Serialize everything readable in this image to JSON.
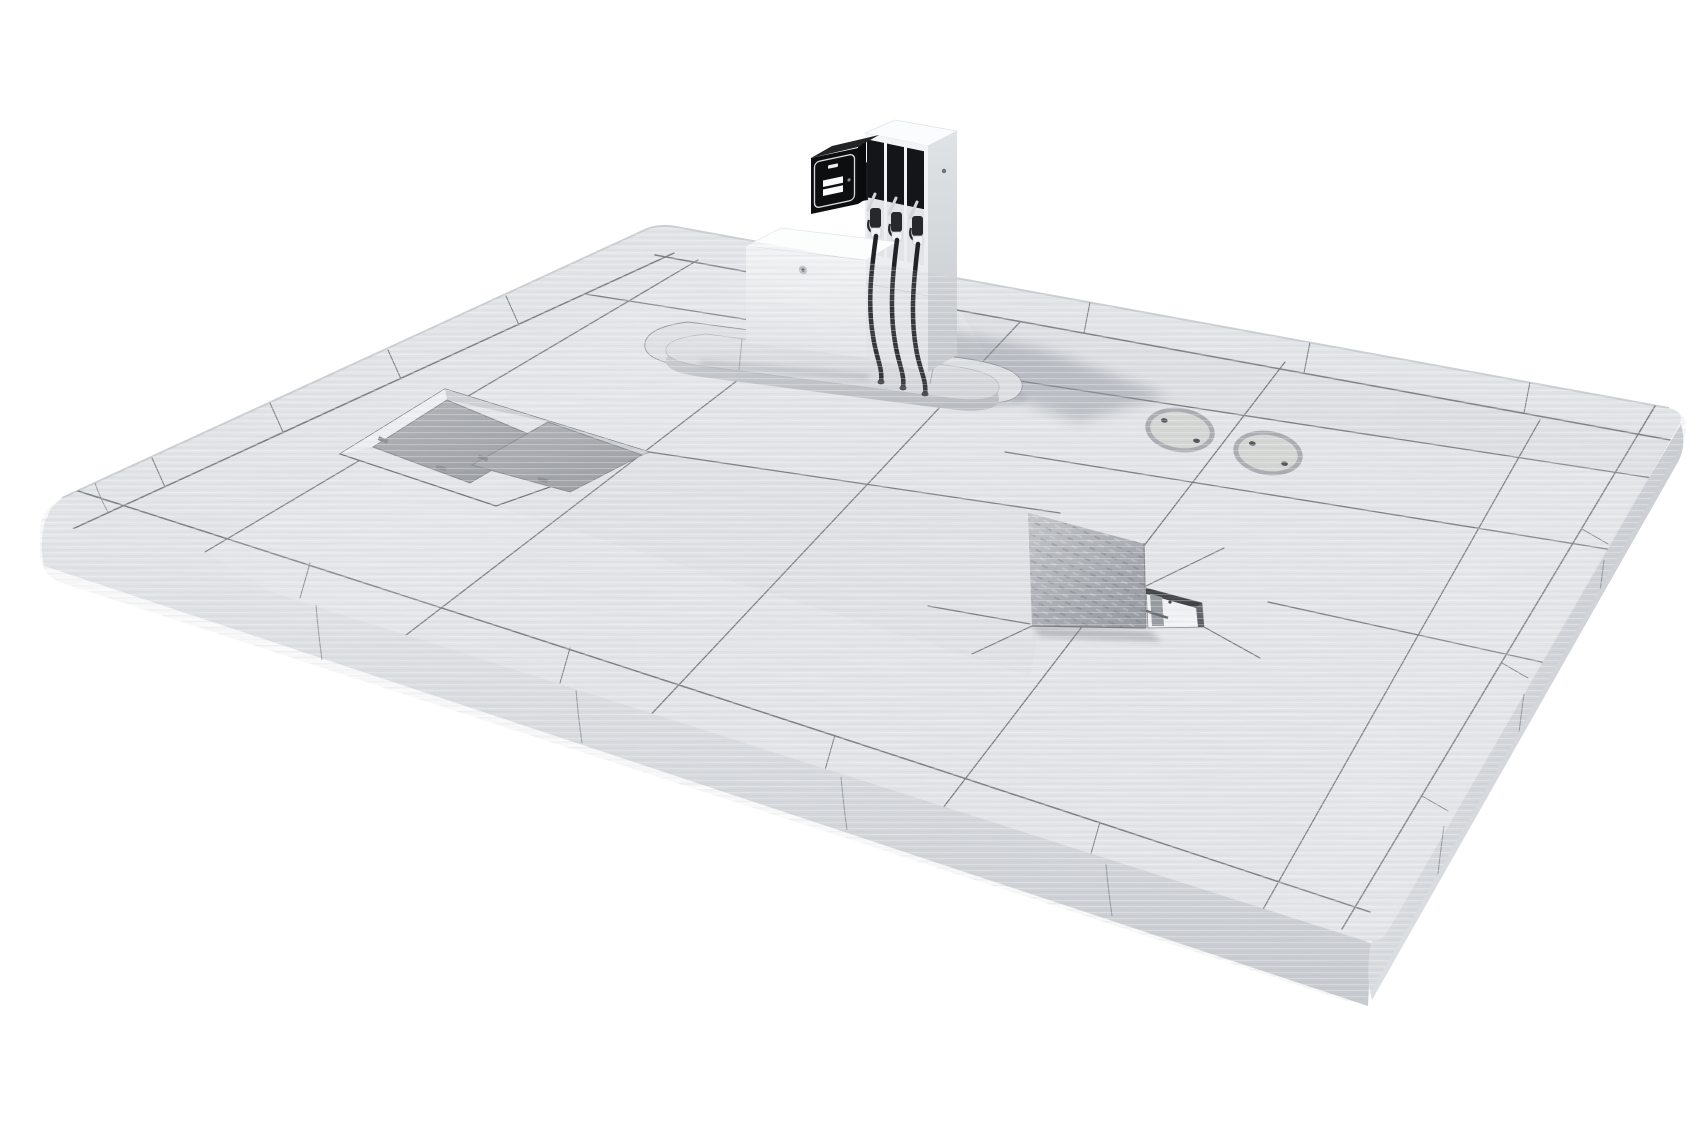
{
  "meta": {
    "title": "3D render of a petrol station forecourt platform",
    "view": "isometric three-quarter aerial view",
    "background": "#ffffff"
  },
  "scene": {
    "platform": {
      "label": "Tiled concrete forecourt slab with bullnose kerb edging",
      "tile_count_visible": "large format slabs with border course",
      "texture": "horizontally streaked light concrete"
    },
    "fuel_dispenser": {
      "label": "Multi-product fuel dispenser column",
      "nozzle_count": 3,
      "features": [
        "three black nozzle bays",
        "three hanging hoses",
        "side bolt"
      ]
    },
    "payment_terminal": {
      "label": "Black payment terminal head",
      "features": [
        "rounded bezel outline",
        "card slot",
        "two receipt slots",
        "indicator dot"
      ]
    },
    "cabinet": {
      "label": "White equipment cabinet",
      "features": [
        "round lock"
      ]
    },
    "island": {
      "label": "Raised oval concrete dispenser island with surrounding apron"
    },
    "access_covers": {
      "label": "Recessed rectangular tank access covers",
      "count": 2,
      "features": [
        "lift tabs"
      ]
    },
    "manhole_covers": {
      "label": "Round flush manhole covers",
      "count": 2,
      "bolts_per_cover": 2
    },
    "inspection_hatch": {
      "label": "Open chequer-plate inspection hatch",
      "features": [
        "standing open lid",
        "open frame pit",
        "support rod",
        "diagonal slab cuts"
      ]
    },
    "shadow": {
      "label": "Soft shadow cast by dispenser toward lower right"
    }
  },
  "colors": {
    "bg": "#ffffff",
    "tile": "#e7e9ec",
    "joint": "#5f646a",
    "curb": "#d7dade",
    "panel": "#141518",
    "dispenser": "#f1f3f5",
    "terminal": "#0d0e10",
    "plate": "#a6a9ad",
    "lid": "#a9adb3",
    "manhole": "#d7d9d6",
    "pad": "#dfe2e5",
    "shadow": "#858c95",
    "hose": "#202226"
  }
}
